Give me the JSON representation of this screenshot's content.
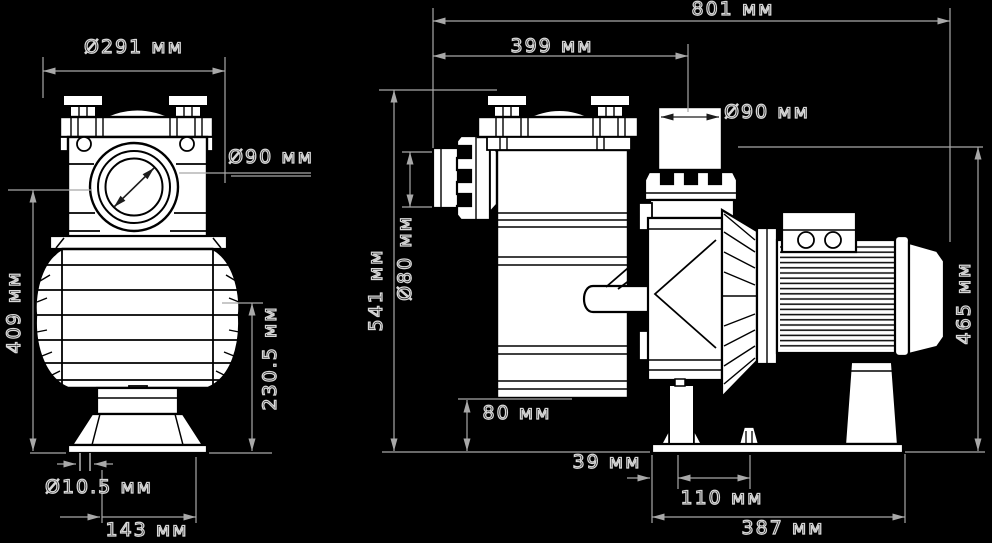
{
  "unit": "мм",
  "colors": {
    "background": "#000000",
    "part_fill": "#ffffff",
    "part_outline": "#000000",
    "dimension_lines": "#a8a8a8",
    "label_outline": "#d8d8d8"
  },
  "front_view": {
    "dims": {
      "flange_diameter": "Ø291 мм",
      "port_diameter": "Ø90 мм",
      "port_center_height": "409 мм",
      "tank_center_height": "230.5 мм",
      "foot_hole_diameter": "Ø10.5 мм",
      "foot_hole_span": "143 мм"
    }
  },
  "side_view": {
    "dims": {
      "overall_length": "801 мм",
      "inlet_to_outlet_center": "399 мм",
      "overall_height": "541 мм",
      "inlet_diameter": "Ø80 мм",
      "outlet_diameter": "Ø90 мм",
      "tank_bottom_clearance": "80 мм",
      "base_edge_to_first_hole": "39 мм",
      "foot_hole_spacing": "110 мм",
      "base_length": "387 мм",
      "outlet_top_height": "465 мм"
    }
  }
}
